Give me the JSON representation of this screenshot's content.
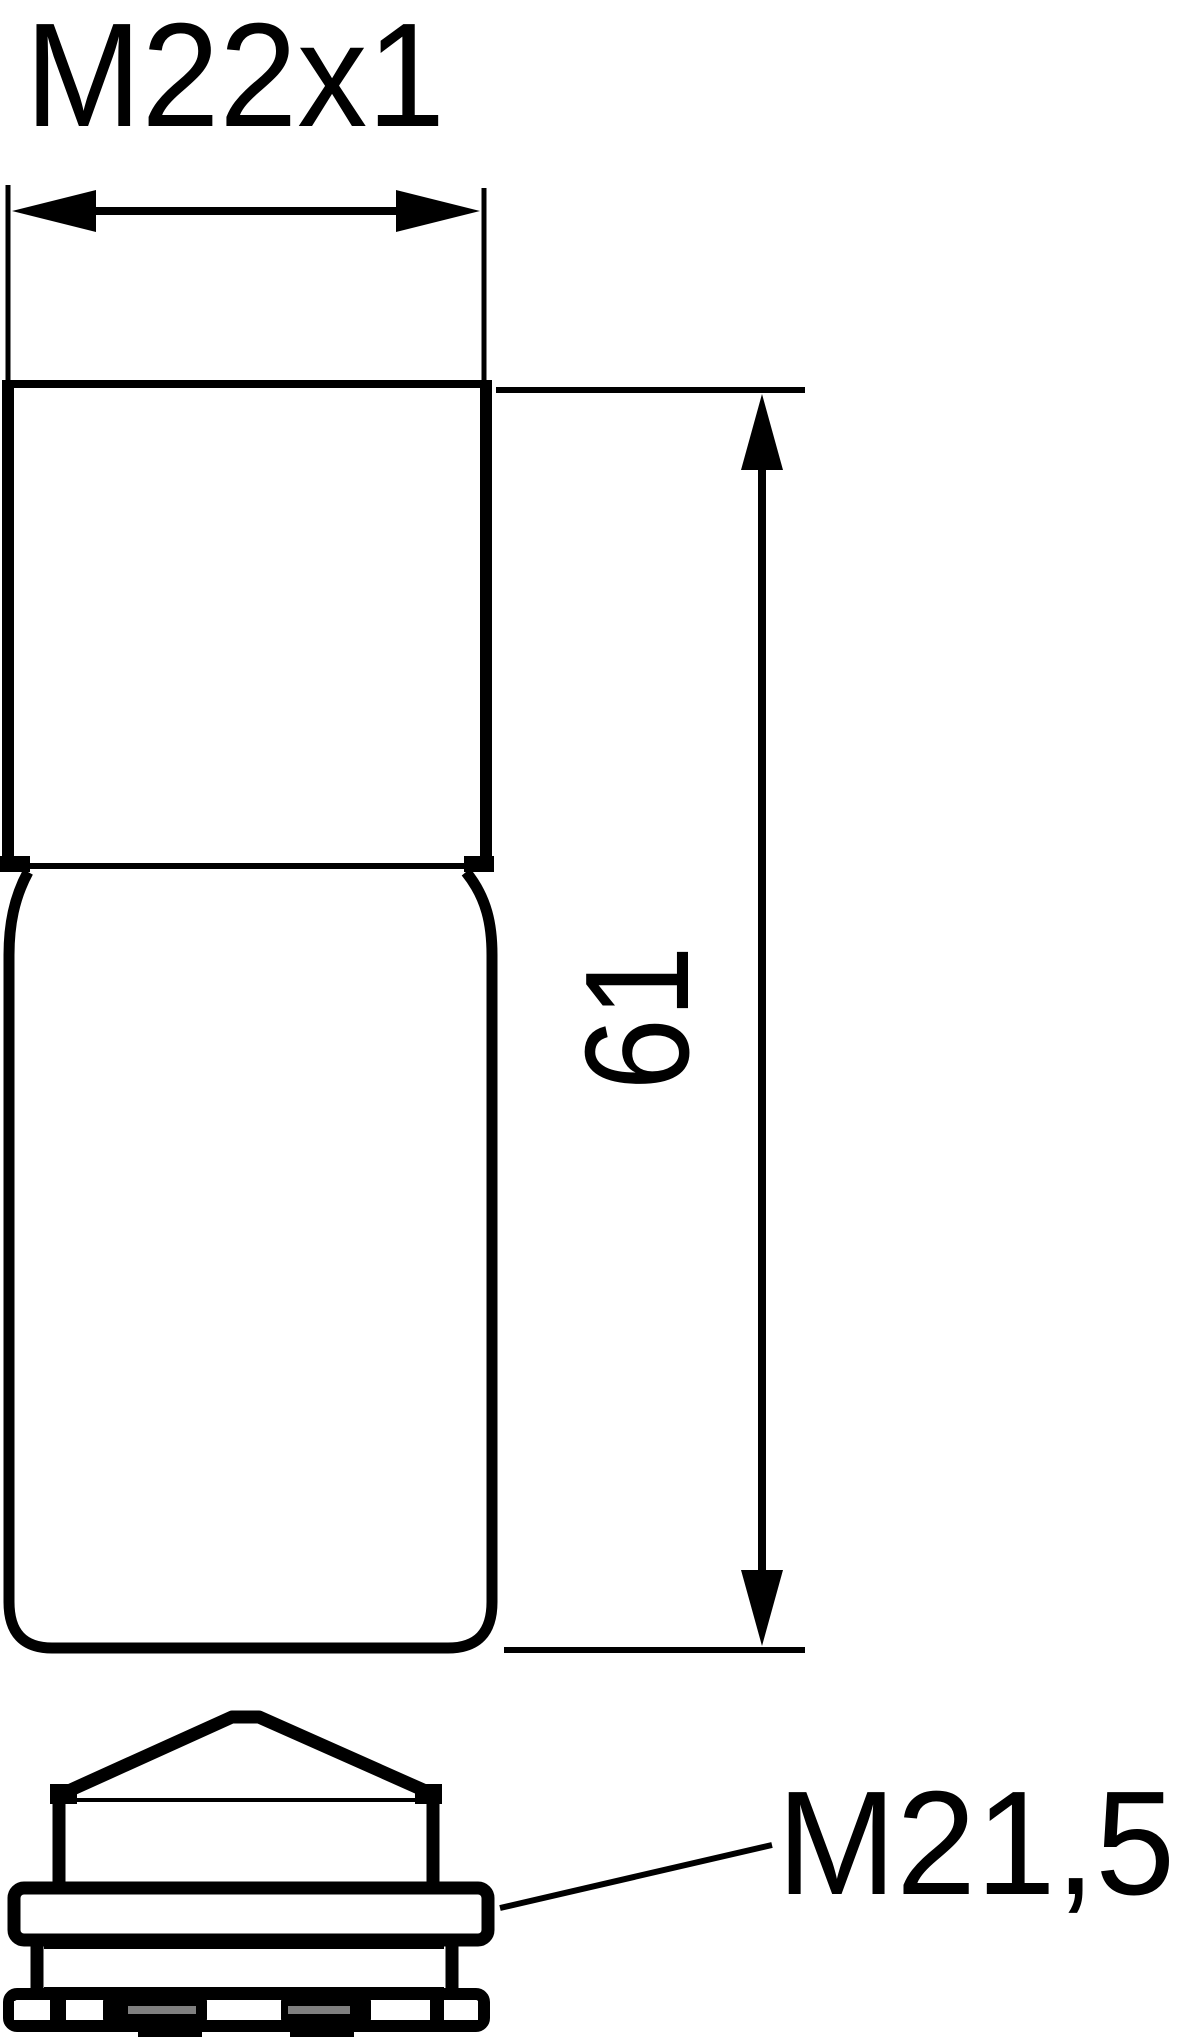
{
  "drawing": {
    "type": "technical-dimension-drawing",
    "background_color": "#ffffff",
    "line_color": "#000000",
    "slot_color": "#7f7f7f",
    "labels": {
      "top_thread": "M22x1",
      "body_length": "61",
      "bottom_thread": "M21,5"
    },
    "dimensions": [
      {
        "label": "M22x1",
        "orientation": "horizontal",
        "placement": "top"
      },
      {
        "label": "61",
        "orientation": "vertical",
        "placement": "right"
      },
      {
        "label": "M21,5",
        "orientation": "leader",
        "placement": "bottom-right"
      }
    ]
  }
}
